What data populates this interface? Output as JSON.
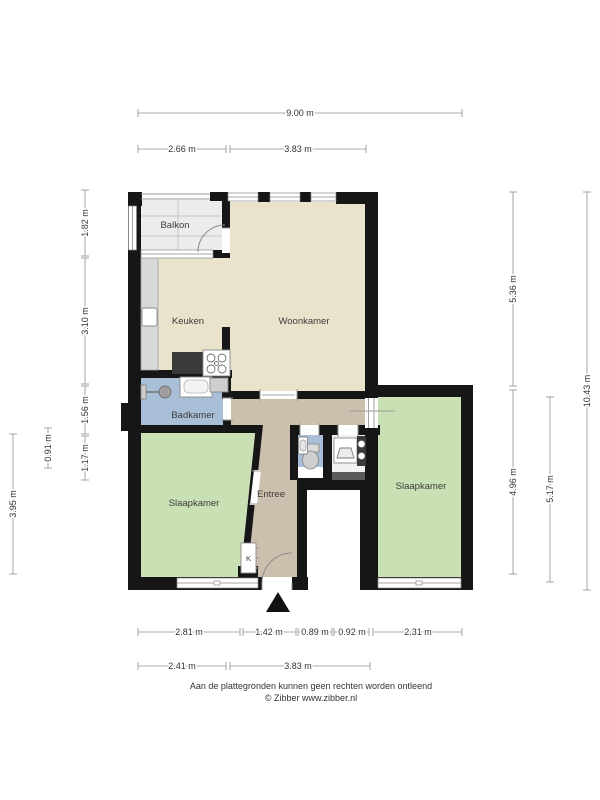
{
  "floorplan": {
    "rooms": {
      "balkon": "Balkon",
      "keuken": "Keuken",
      "woonkamer": "Woonkamer",
      "badkamer": "Badkamer",
      "slaapkamer_links": "Slaapkamer",
      "entree": "Entree",
      "slaapkamer_rechts": "Slaapkamer",
      "kast": "K"
    },
    "dimensions": {
      "top_total": "9.00 m",
      "top_left": "2.66 m",
      "top_right": "3.83 m",
      "left_balkon": "1.82 m",
      "left_keuken": "3.10 m",
      "left_badkamer": "1.56 m",
      "left_hal": "1.17 m",
      "left_klein": "0.91 m",
      "left_slaapkamer": "3.95 m",
      "right_boven": "5.36 m",
      "right_onder_binnen": "4.96 m",
      "right_onder_buiten": "5.17 m",
      "right_totaal": "10.43 m",
      "bottom_slaapkamer_links": "2.81 m",
      "bottom_entree": "1.42 m",
      "bottom_wc": "0.89 m",
      "bottom_washok": "0.92 m",
      "bottom_slaapkamer_rechts": "2.31 m",
      "bottom2_links": "2.41 m",
      "bottom2_rechts": "3.83 m"
    },
    "colors": {
      "wall": "#161616",
      "woonkeuken": "#EAE3CC",
      "slaapkamer": "#C9E0B4",
      "badkamer": "#A9BFD8",
      "entree": "#CDBFAD",
      "balkon": "#ECECEA"
    }
  },
  "footer": {
    "disclaimer": "Aan de plattegronden kunnen geen rechten worden ontleend",
    "copyright": "© Zibber www.zibber.nl"
  }
}
